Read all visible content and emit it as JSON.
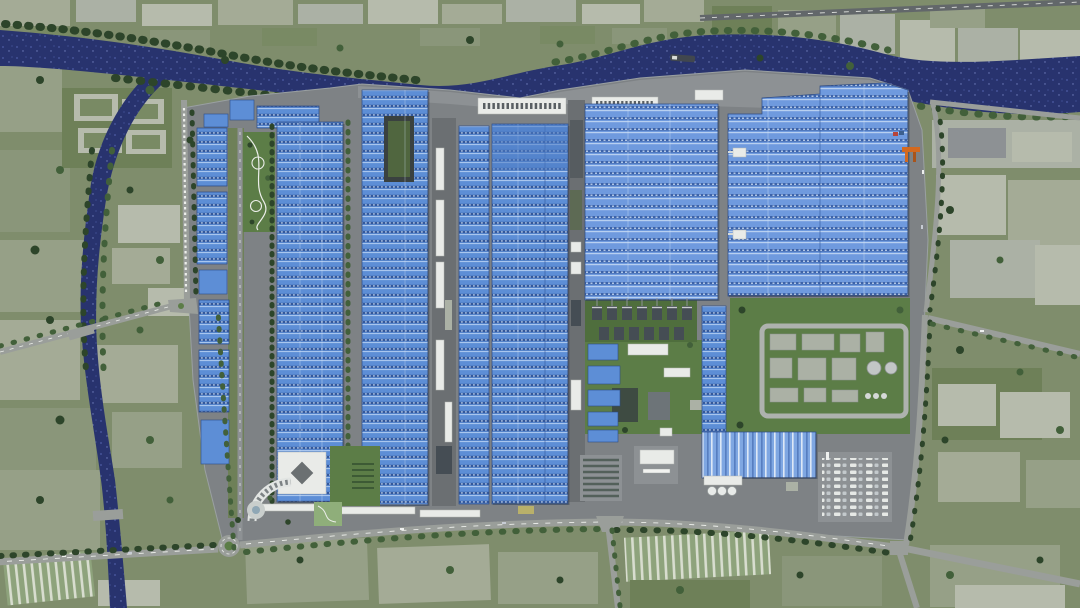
{
  "scene": {
    "type": "aerial-3d-render",
    "subject": "riverside-industrial-factory-campus-master-plan",
    "text_visible": false,
    "features": [
      "winding-navy-river",
      "river-branch-canal",
      "riverside-wharf",
      "cargo-barge",
      "orange-container-crane",
      "blue-solar-roof-factory-halls",
      "rooftop-courtyard",
      "cooling-tower-rows",
      "utility-water-treatment-yard",
      "blue-warehouse",
      "white-storage-spheres",
      "parking-lot-with-cars",
      "white-office-building",
      "arc-shaped-gallery-building",
      "entrance-roundabout",
      "landscaped-park-paths",
      "farm-field-patchwork",
      "greenhouse-strips",
      "village-blocks-across-river",
      "perimeter-roads",
      "tree-rows"
    ],
    "counts": {
      "large_factory_halls": 6,
      "dock_warehouses": 3,
      "cooling_towers": 13,
      "storage_spheres": 3
    },
    "colors": {
      "river": "#28336e",
      "riverDot": "#4d5ca6",
      "riverDot2": "#7280bf",
      "fieldBase": "#7f8d6c",
      "f1": "#96a087",
      "f2": "#8a967a",
      "f3": "#a4ab96",
      "f4": "#6e8058",
      "f5": "#b6bbac",
      "f6": "#798a64",
      "lawn": "#5c7d47",
      "lawnDark": "#4f6e3d",
      "tree1": "#2d452a",
      "tree2": "#42603a",
      "road": "#9a9e9a",
      "roadDark": "#62676a",
      "roadLight": "#aeb2ae",
      "lineWhite": "#eceeea",
      "plat": "#7e8285",
      "platLight": "#8d9194",
      "platDark": "#6b6f72",
      "roofBase": "#5d8ed6",
      "roofDark": "#33589c",
      "roofLight": "#a9c6ee",
      "roofDot": "#cfe0f4",
      "roofEdge": "#2c4b86",
      "roof2Base": "#6f9ade",
      "roof2Dark": "#3c63aa",
      "roof2Light": "#b8d0f0",
      "roof3Base": "#7fa7e2",
      "white": "#e9ebe8",
      "grayBldg": "#abb1a5",
      "darkUnit": "#454d54",
      "orange": "#d3691f",
      "pondDark": "#3e4b42"
    }
  }
}
